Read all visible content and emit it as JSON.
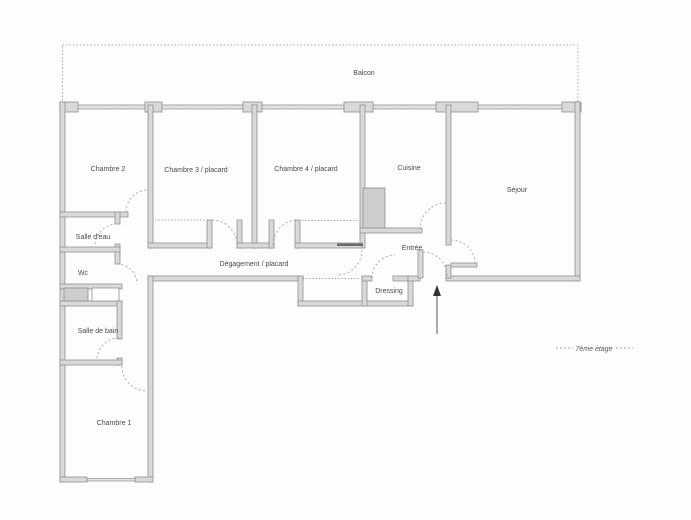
{
  "colors": {
    "wall_fill": "#d9d9d9",
    "wall_stroke": "#8f8f8f",
    "dashed_lines": "#9a9a9a",
    "label_text": "#4a4a4a",
    "background": "#fdfdfd"
  },
  "labels": {
    "balcony": "Balcon",
    "bedroom2": "Chambre 2",
    "bedroom3": "Chambre 3 / placard",
    "bedroom4": "Chambre 4 / placard",
    "kitchen": "Cuisine",
    "living_room": "Séjour",
    "shower_room": "Salle d'eau",
    "wc": "Wc",
    "hallway": "Dégagement / placard",
    "entrance": "Entrée",
    "dressing": "Dressing",
    "bathroom": "Salle de bain",
    "bedroom1": "Chambre 1",
    "floor_note": "7ème étage"
  }
}
